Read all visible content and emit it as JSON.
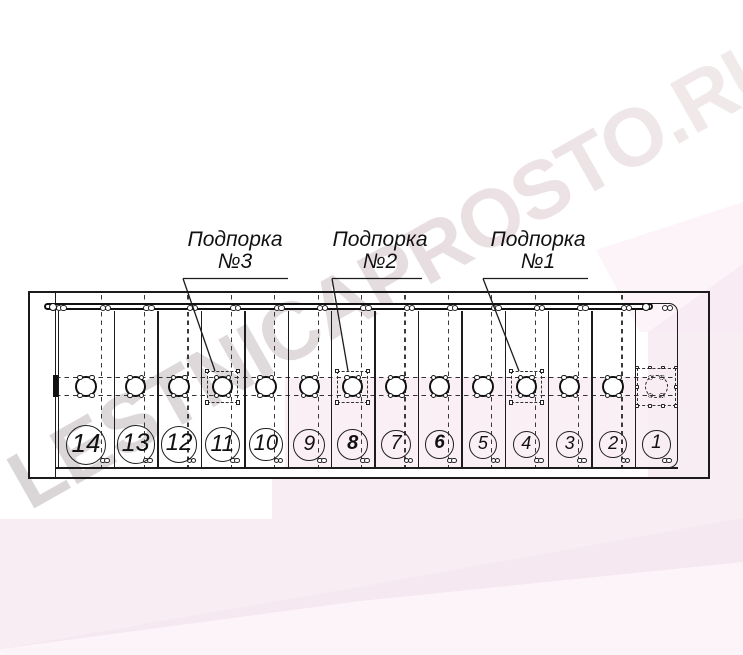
{
  "watermark": {
    "text": "LESTNICAPROSTO.RU"
  },
  "colors": {
    "line": "#1c1c1c",
    "pink_band_main": "#f8e9f1",
    "pink_band_inner": "#f6e2ec",
    "pink_band_light": "#fdf5f9",
    "watermark_gray": "#d5d1d3",
    "watermark_pink": "#f0e9e9"
  },
  "supports": [
    {
      "name": "Подпорка",
      "number": "№3",
      "target_step": "11"
    },
    {
      "name": "Подпорка",
      "number": "№2",
      "target_step": "8"
    },
    {
      "name": "Подпорка",
      "number": "№1",
      "target_step": "4"
    }
  ],
  "drawing": {
    "steps": [
      {
        "number": "14"
      },
      {
        "number": "13"
      },
      {
        "number": "12"
      },
      {
        "number": "11",
        "support": "№3"
      },
      {
        "number": "10"
      },
      {
        "number": "9"
      },
      {
        "number": "8",
        "support": "№2",
        "bold": true
      },
      {
        "number": "7"
      },
      {
        "number": "6",
        "bold": true
      },
      {
        "number": "5"
      },
      {
        "number": "4",
        "support": "№1"
      },
      {
        "number": "3"
      },
      {
        "number": "2"
      },
      {
        "number": "1",
        "dashed_outline": true
      }
    ]
  }
}
